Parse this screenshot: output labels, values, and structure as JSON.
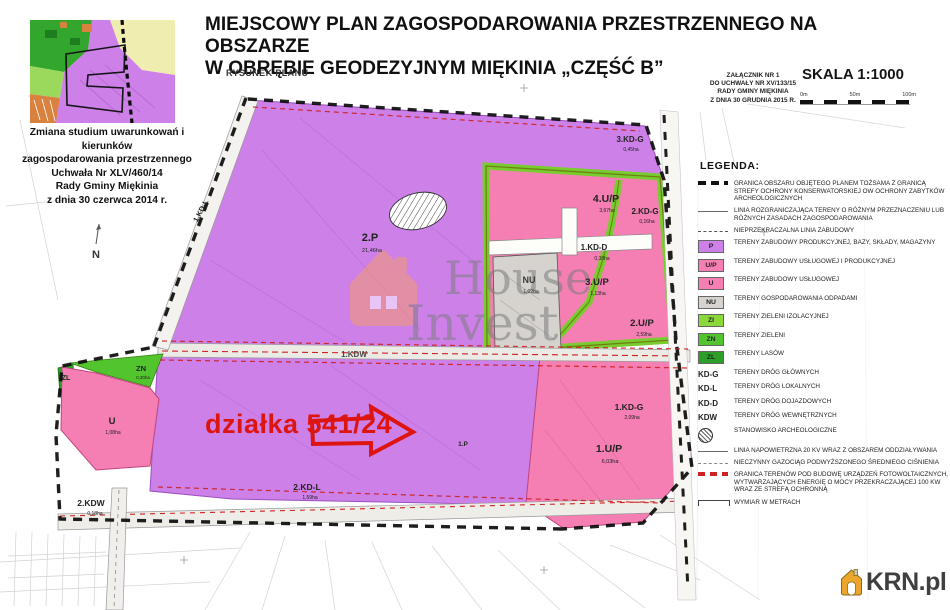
{
  "header": {
    "title_line1": "MIEJSCOWY PLAN ZAGOSPODAROWANIA PRZESTRZENNEGO NA OBSZARZE",
    "title_line2": "W OBRĘBIE GEODEZYJNYM MIĘKINIA  „CZĘŚĆ B”",
    "subtitle": "RYSUNEK PLANU",
    "attachment": [
      "ZAŁĄCZNIK NR 1",
      "DO UCHWAŁY NR XV/133/15",
      "RADY GMINY MIĘKINIA",
      "Z DNIA 30 GRUDNIA 2015 R.",
      "SKALA 1:1000"
    ],
    "scale_label": "SKALA 1:1000",
    "scale_ticks": [
      "0m",
      "50m",
      "100m"
    ]
  },
  "inset": {
    "caption_lines": [
      "Zmiana studium uwarunkowań i kierunków",
      "zagospodarowania przestrzennego",
      "Uchwała Nr XLV/460/14",
      "Rady Gminy Miękinia",
      "z dnia 30 czerwca 2014 r."
    ]
  },
  "legend": {
    "title": "LEGENDA:",
    "items": [
      {
        "label": "GRANICA OBSZARU OBJĘTEGO PLANEM TOŻSAMA Z GRANICĄ STREFY OCHRONY KONSERWATORSKIEJ OW OCHRONY ZABYTKÓW ARCHEOLOGICZNYCH"
      },
      {
        "label": "LINIA ROZGRANICZAJĄCA TERENY O RÓŻNYM PRZEZNACZENIU LUB RÓŻNYCH ZASADACH ZAGOSPODAROWANIA"
      },
      {
        "label": "NIEPRZEKRACZALNA LINIA ZABUDOWY"
      },
      {
        "code": "P",
        "label": "TERENY ZABUDOWY PRODUKCYJNEJ, BAZY, SKŁADY, MAGAZYNY"
      },
      {
        "code": "U/P",
        "label": "TERENY ZABUDOWY USŁUGOWEJ I PRODUKCYJNEJ"
      },
      {
        "code": "U",
        "label": "TERENY ZABUDOWY USŁUGOWEJ"
      },
      {
        "code": "NU",
        "label": "TERENY GOSPODAROWANIA ODPADAMI"
      },
      {
        "code": "ZI",
        "label": "TERENY ZIELENI IZOLACYJNEJ"
      },
      {
        "code": "ZN",
        "label": "TERENY ZIELENI"
      },
      {
        "code": "ZL",
        "label": "TERENY LASÓW"
      },
      {
        "code": "KD-G",
        "label": "TERENY DRÓG GŁÓWNYCH"
      },
      {
        "code": "KD-L",
        "label": "TERENY DRÓG LOKALNYCH"
      },
      {
        "code": "KD-D",
        "label": "TERENY DRÓG DOJAZDOWYCH"
      },
      {
        "code": "KDW",
        "label": "TERENY DRÓG WEWNĘTRZNYCH"
      },
      {
        "label": "STANOWISKO ARCHEOLOGICZNE"
      },
      {
        "label": "LINIA NAPOWIETRZNA 20 KV WRAZ Z OBSZAREM ODDZIAŁYWANIA"
      },
      {
        "label": "NIECZYNNY GAZOCIĄG PODWYŻSZONEGO ŚREDNIEGO CIŚNIENIA"
      },
      {
        "label": "GRANICA TERENÓW POD BUDOWĘ URZĄDZEŃ FOTOWOLTAICZNYCH, WYTWARZAJĄCYCH ENERGIĘ O MOCY PRZEKRACZAJĄCEJ 100 KW WRAZ ZE STREFĄ OCHRONNĄ"
      },
      {
        "label": "WYMIAR W METRACH"
      }
    ]
  },
  "map": {
    "north_label": "N",
    "highlight_text": "działka 541/24",
    "watermark": {
      "line1": "House",
      "line2": "Invest"
    },
    "zones": [
      {
        "code": "2.P",
        "area": "21,46ha"
      },
      {
        "code": "3.KD-G",
        "area": "0,45ha"
      },
      {
        "code": "4.U/P",
        "area": "3,67ha"
      },
      {
        "code": "2.KD-G",
        "area": "0,16ha"
      },
      {
        "code": "1.KD-D",
        "area": "0,38ha"
      },
      {
        "code": "3.U/P",
        "area": "1,13ha"
      },
      {
        "code": "2.U/P",
        "area": "2,59ha"
      },
      {
        "code": "NU",
        "area": "1,02ha"
      },
      {
        "code": "1.KD-G",
        "area": "2,09ha"
      },
      {
        "code": "1.U/P",
        "area": "6,03ha"
      },
      {
        "code": "1.KDW"
      },
      {
        "code": "ZN",
        "area": "0,30ha"
      },
      {
        "code": "ZL"
      },
      {
        "code": "U",
        "area": "1,08ha"
      },
      {
        "code": "2.KD-L",
        "area": "1,59ha"
      },
      {
        "code": "2.KDW",
        "area": "0,18ha"
      },
      {
        "code": "1.KD-L"
      },
      {
        "code": "1.P"
      }
    ]
  },
  "colors": {
    "p_zone": "#cd80e8",
    "up_zone": "#f57fb2",
    "u_zone": "#f57fb2",
    "nu_zone": "#d6d3cf",
    "zi_zone": "#8ad83a",
    "zn_zone": "#52c42e",
    "zl_zone": "#2d9f28",
    "highlight_red": "#dd1510",
    "brand_orange": "#eda62d"
  },
  "branding": {
    "logo_text": "KRN.pl"
  }
}
